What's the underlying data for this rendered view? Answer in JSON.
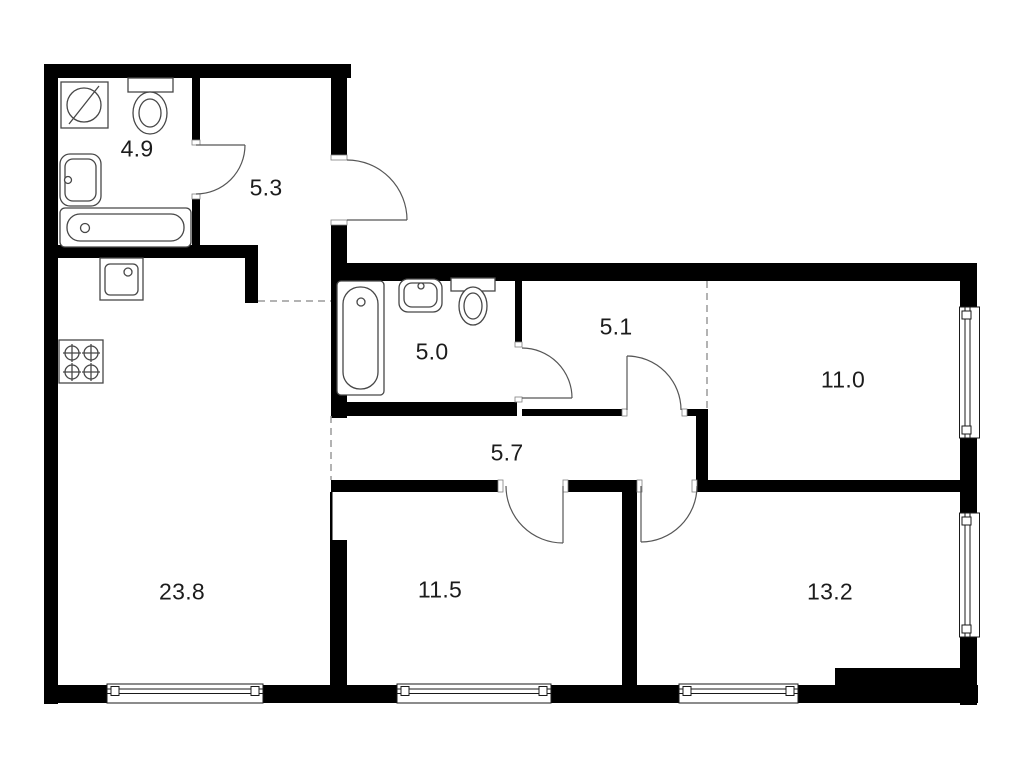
{
  "plan_title": "apartment-floor-plan",
  "colors": {
    "wall": "#000000",
    "background": "#ffffff",
    "fixture_line": "#474747",
    "door_line": "#565656",
    "dashed_line": "#9a9a9a",
    "label": "#1c1c1c"
  },
  "rooms": [
    {
      "id": "bathroom-top",
      "label": "4.9"
    },
    {
      "id": "hallway",
      "label": "5.3"
    },
    {
      "id": "bathroom-middle",
      "label": "5.0"
    },
    {
      "id": "hall",
      "label": "5.1"
    },
    {
      "id": "room-right-top",
      "label": "11.0"
    },
    {
      "id": "corridor",
      "label": "5.7"
    },
    {
      "id": "kitchen-living",
      "label": "23.8"
    },
    {
      "id": "room-bottom-mid",
      "label": "11.5"
    },
    {
      "id": "room-bottom-right",
      "label": "13.2"
    }
  ],
  "fixtures": [
    "washing-machine",
    "toilet",
    "wall-sink",
    "bathtub",
    "kitchen-sink",
    "stove-4-burner",
    "bathtub-2",
    "sink-2",
    "toilet-2"
  ],
  "doors_count": 6,
  "windows_count": 5
}
